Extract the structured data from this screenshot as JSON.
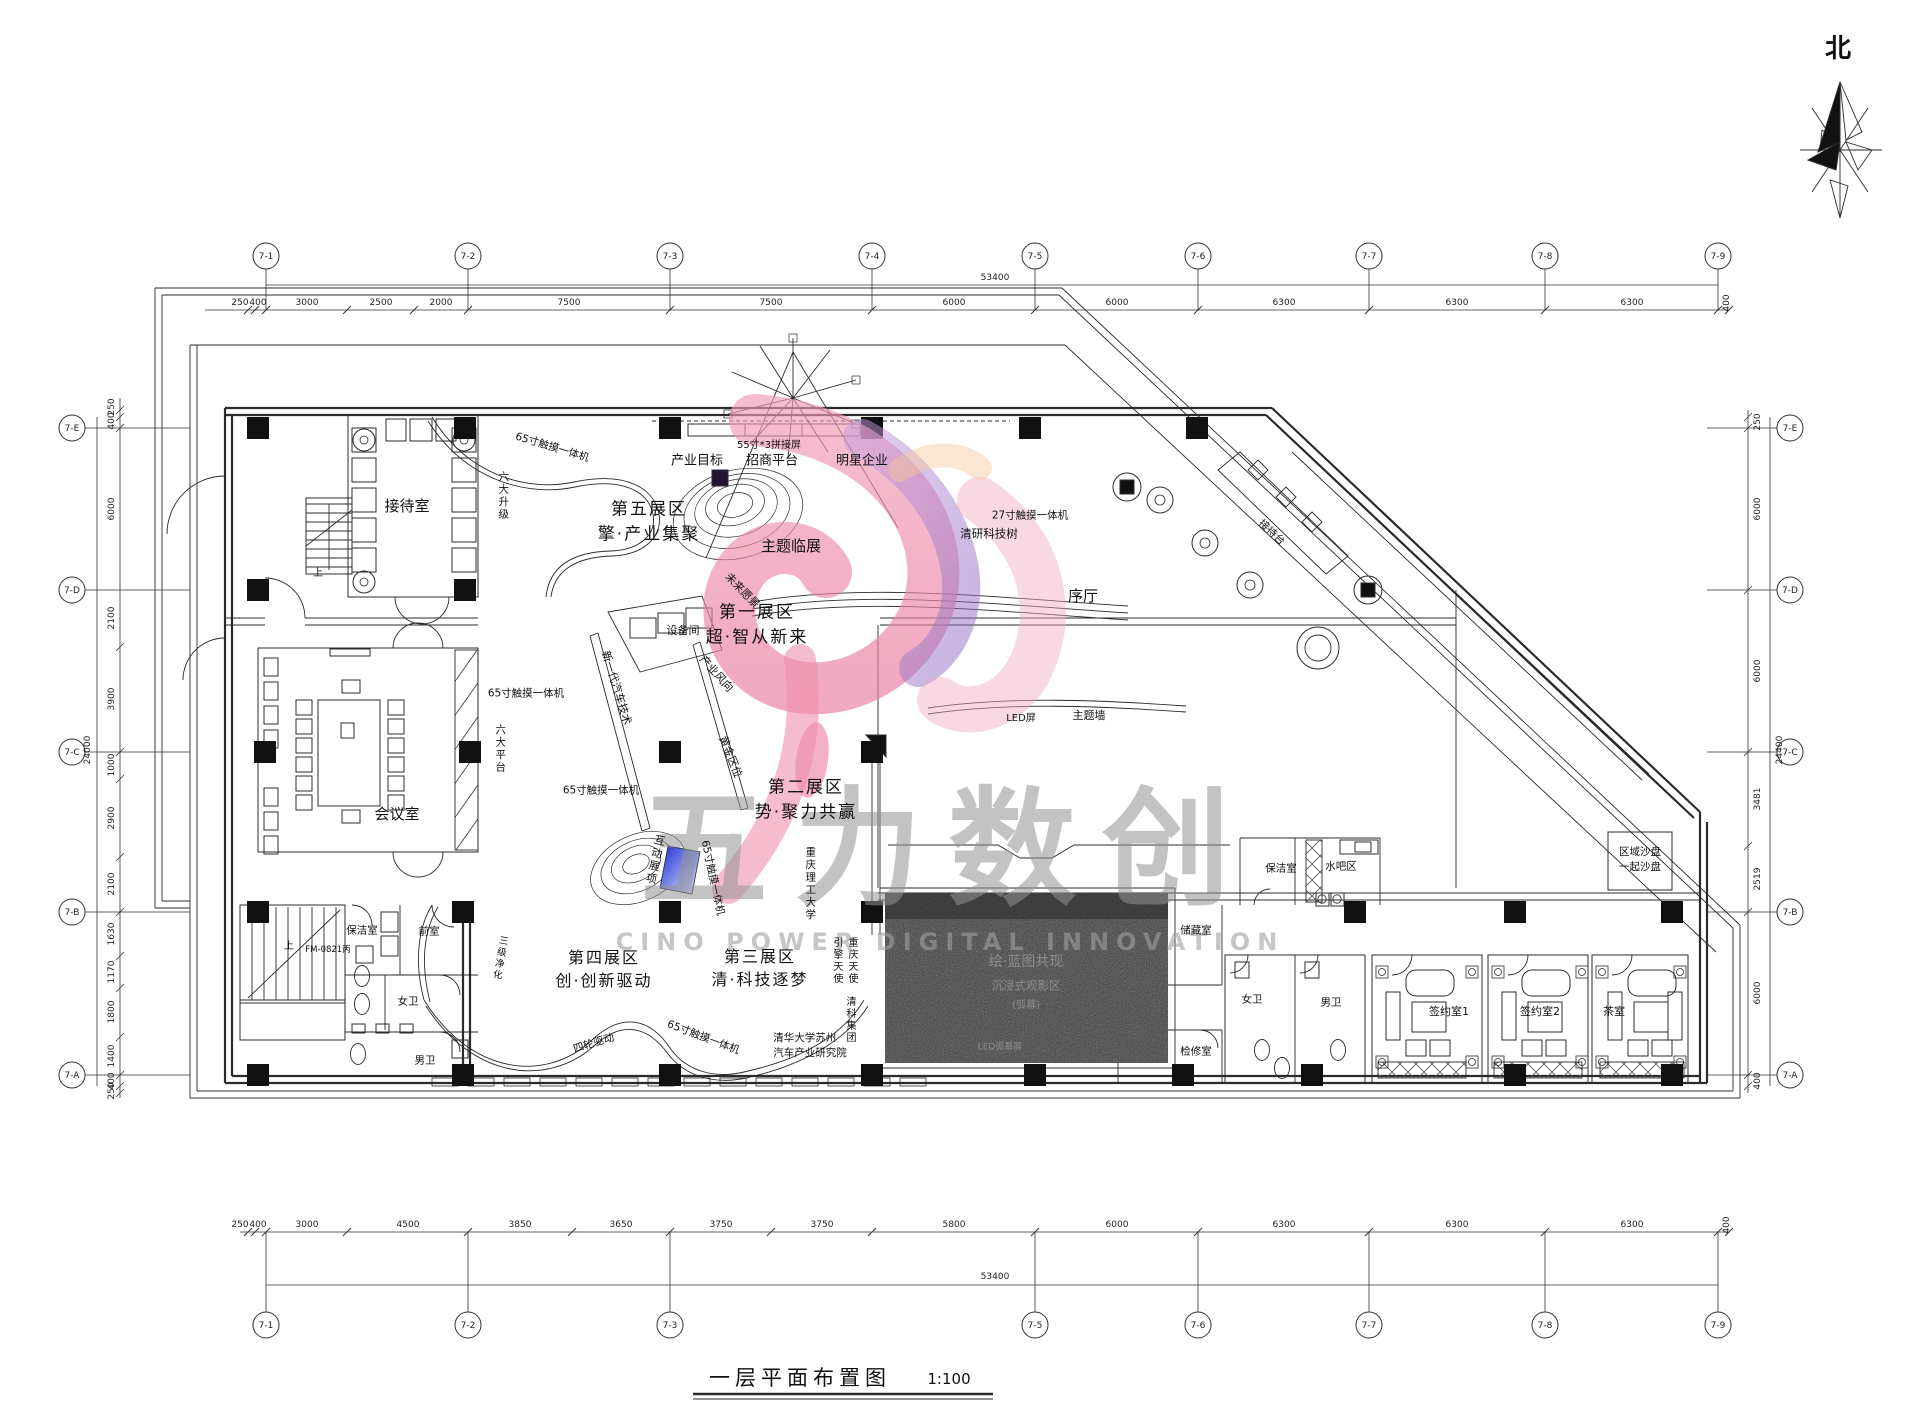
{
  "north_label": "北",
  "title": {
    "text": "一层平面布置图",
    "scale": "1:100"
  },
  "watermark": {
    "chars": "五力数创",
    "subtitle": "CINO POWER DIGITAL INNOVATION"
  },
  "grid": {
    "top": [
      "7-1",
      "7-2",
      "7-3",
      "7-4",
      "7-5",
      "7-6",
      "7-7",
      "7-8",
      "7-9"
    ],
    "bottom": [
      "7-1",
      "7-2",
      "7-3",
      "7-5",
      "7-6",
      "7-7",
      "7-8",
      "7-9"
    ],
    "left": [
      "7-E",
      "7-D",
      "7-C",
      "7-B",
      "7-A"
    ],
    "right": [
      "7-E",
      "7-D",
      "7-C",
      "7-B",
      "7-A"
    ]
  },
  "dims": {
    "top": [
      "250",
      "400",
      "3000",
      "2500",
      "2000",
      "7500",
      "7500",
      "6000",
      "6000",
      "6300",
      "6300",
      "6300",
      "400"
    ],
    "top_total": "53400",
    "bottom": [
      "250",
      "400",
      "3000",
      "4500",
      "3850",
      "3650",
      "3750",
      "3750",
      "5800",
      "6000",
      "6300",
      "6300",
      "6300",
      "400"
    ],
    "bottom_total": "53400",
    "left": [
      "250",
      "400",
      "6000",
      "2100",
      "3900",
      "1000",
      "2900",
      "2100",
      "1630",
      "1170",
      "1800",
      "1400",
      "400",
      "250"
    ],
    "left_total": "24000",
    "right": [
      "250",
      "6000",
      "6000",
      "3481",
      "2519",
      "6000",
      "400"
    ],
    "right_total": "24400"
  },
  "labels": [
    {
      "id": "reception",
      "t": "接待室"
    },
    {
      "id": "meeting",
      "t": "会议室"
    },
    {
      "id": "zone5",
      "t": "第五展区\n擎·产业集聚"
    },
    {
      "id": "zone1",
      "t": "第一展区\n超·智从新来"
    },
    {
      "id": "zone2",
      "t": "第二展区\n势·聚力共赢"
    },
    {
      "id": "zone3",
      "t": "第三展区\n清·科技逐梦"
    },
    {
      "id": "zone4",
      "t": "第四展区\n创·创新驱动"
    },
    {
      "id": "theme_temp",
      "t": "主题临展"
    },
    {
      "id": "lobby",
      "t": "序厅"
    },
    {
      "id": "equipment",
      "t": "设备间"
    },
    {
      "id": "industry_goal",
      "t": "产业目标"
    },
    {
      "id": "invest",
      "t": "招商平台"
    },
    {
      "id": "star",
      "t": "明星企业"
    },
    {
      "id": "splice55",
      "t": "55寸*3拼接屏"
    },
    {
      "id": "touch65_a",
      "t": "65寸触摸一体机"
    },
    {
      "id": "touch65_b",
      "t": "65寸触摸一体机"
    },
    {
      "id": "touch65_c",
      "t": "65寸触摸一体机"
    },
    {
      "id": "touch65_d",
      "t": "65寸触摸一体机"
    },
    {
      "id": "touch65_e",
      "t": "65寸触摸一体机"
    },
    {
      "id": "touch27",
      "t": "27寸触摸一体机"
    },
    {
      "id": "tech_tree",
      "t": "清研科技树"
    },
    {
      "id": "six_up",
      "t": "六大升级",
      "v": 1
    },
    {
      "id": "six_plat",
      "t": "六大平台",
      "v": 1
    },
    {
      "id": "future",
      "t": "未来愿景"
    },
    {
      "id": "newgen",
      "t": "新一代汽车技术"
    },
    {
      "id": "golden",
      "t": "黄金区位"
    },
    {
      "id": "wind",
      "t": "产业风向"
    },
    {
      "id": "interactive",
      "t": "互动展项",
      "v": 1
    },
    {
      "id": "cqut",
      "t": "重庆理工大学",
      "v": 1
    },
    {
      "id": "led",
      "t": "LED屏"
    },
    {
      "id": "themewall",
      "t": "主题墙"
    },
    {
      "id": "recdesk",
      "t": "接待台"
    },
    {
      "id": "sandbox",
      "t": "区域沙盘\n一起沙盘"
    },
    {
      "id": "clean_r",
      "t": "保洁室"
    },
    {
      "id": "waterbar",
      "t": "水吧区"
    },
    {
      "id": "storage",
      "t": "储藏室"
    },
    {
      "id": "women_r",
      "t": "女卫"
    },
    {
      "id": "men_r",
      "t": "男卫"
    },
    {
      "id": "sign1",
      "t": "签约室1"
    },
    {
      "id": "sign2",
      "t": "签约室2"
    },
    {
      "id": "tea",
      "t": "茶室"
    },
    {
      "id": "inspect",
      "t": "检修室"
    },
    {
      "id": "clean_l",
      "t": "保洁室"
    },
    {
      "id": "ante",
      "t": "前室"
    },
    {
      "id": "women_l",
      "t": "女卫"
    },
    {
      "id": "men_l",
      "t": "男卫"
    },
    {
      "id": "fm",
      "t": "FM-0821丙"
    },
    {
      "id": "up1",
      "t": "上"
    },
    {
      "id": "up2",
      "t": "上"
    },
    {
      "id": "purify",
      "t": "三级净化",
      "v": 1
    },
    {
      "id": "fourwheel",
      "t": "四轮驱动"
    },
    {
      "id": "tsinghua",
      "t": "清华大学苏州\n汽车产业研究院"
    },
    {
      "id": "angel1",
      "t": "引擎天使",
      "v": 1
    },
    {
      "id": "angel2",
      "t": "重庆天使",
      "v": 1
    },
    {
      "id": "tskj",
      "t": "清科集团",
      "v": 1
    },
    {
      "id": "dark1",
      "t": "绘·蓝图共现"
    },
    {
      "id": "dark2",
      "t": "沉浸式观影区"
    },
    {
      "id": "dark3",
      "t": "(弧幕)"
    },
    {
      "id": "dark4",
      "t": "LED弧幕屏"
    }
  ]
}
